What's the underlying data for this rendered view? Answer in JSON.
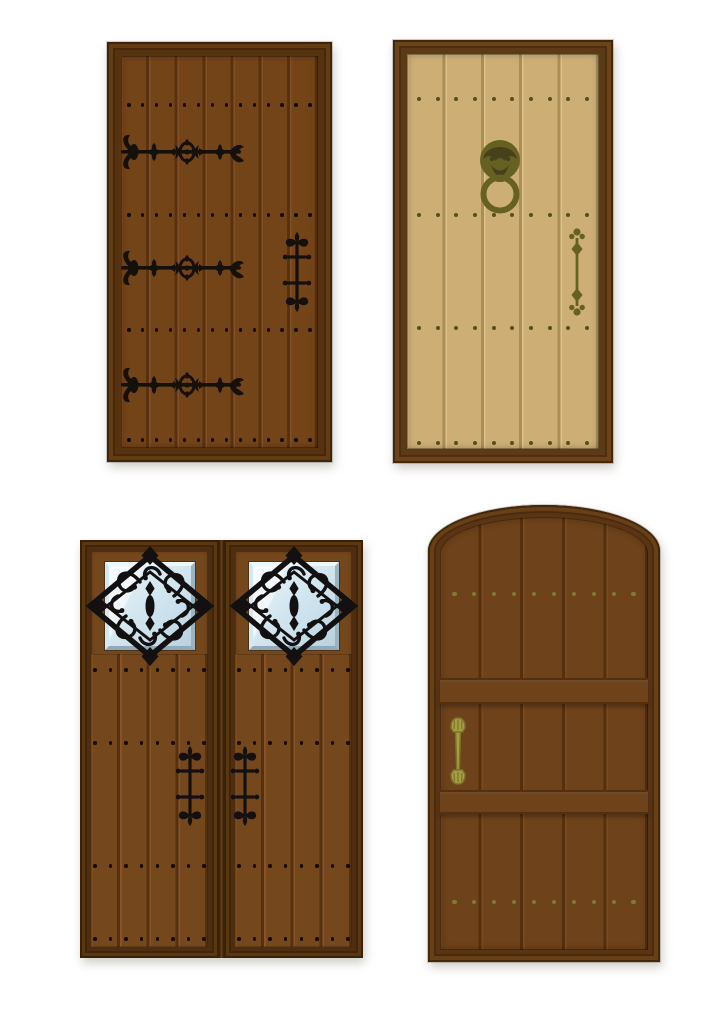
{
  "scene": {
    "description": "Vector illustration of four rustic medieval wooden doors with wrought-iron and brass hardware",
    "background": "#ffffff"
  },
  "doors": [
    {
      "name": "top-left-door",
      "style": "dark brown plank door with three ornate wrought-iron strap hinges and a cross-shaped handle",
      "palette": {
        "frame": "#56320f",
        "frameEdge": "#402409",
        "frameHi": "#633c14",
        "plank": "#744419",
        "groove": "#583210",
        "highlight": "#835026",
        "hardware": "#15100a",
        "hardwareDark": "#000000"
      },
      "planks": 7,
      "nails": {
        "per_row": 14,
        "rows": 4,
        "color": "#140c05",
        "size": 3.5
      },
      "hardware": [
        {
          "icon": "ornate-hinge-icon",
          "count": 3
        },
        {
          "icon": "cross-handle-icon",
          "count": 1
        }
      ]
    },
    {
      "name": "top-right-door",
      "style": "tan plank door with olive-brass ring knocker and vertical bar handle",
      "palette": {
        "frame": "#5d3a16",
        "frameEdge": "#44280c",
        "frameHi": "#6b4419",
        "plank": "#cdaf76",
        "groove": "#aa8e54",
        "highlight": "#dcc28d",
        "hardware": "#666023",
        "hardwareDark": "#46411a"
      },
      "planks": 5,
      "nails": {
        "per_row": 10,
        "rows": 4,
        "color": "#584e21",
        "size": 4
      },
      "hardware": [
        {
          "icon": "ring-knocker-icon",
          "count": 1
        },
        {
          "icon": "bar-handle-icon",
          "count": 1
        }
      ]
    },
    {
      "name": "bottom-left-double-door",
      "style": "double brown plank door, each leaf with a beveled glass window behind a diamond iron grille and a cross-shaped handle",
      "palette": {
        "frame": "#4e2e0e",
        "frameEdge": "#392107",
        "frameHi": "#5a370f",
        "plank": "#75471c",
        "groove": "#563110",
        "highlight": "#855327",
        "hardware": "#131011",
        "hardwareDark": "#000000",
        "glassLight": "#e9f4fa",
        "glass": "#c9dfeb",
        "bevelLight": "#eff7fb",
        "bevelDark": "#9bb4c2",
        "gapDark": "#2f1c09",
        "gapMid": "#6a3f18"
      },
      "leaves": 2,
      "planks_per_leaf": 4,
      "nails": {
        "per_row": 8,
        "rows": 4,
        "color": "#140c05",
        "size": 3.5
      },
      "hardware": [
        {
          "icon": "window-grille-icon",
          "count": 2
        },
        {
          "icon": "cross-handle-icon",
          "count": 2
        }
      ]
    },
    {
      "name": "bottom-right-arched-door",
      "style": "arched brown plank door with two horizontal rails and an olive-brass pull handle",
      "palette": {
        "frame": "#5b3513",
        "frameEdge": "#432708",
        "frameHi": "#684017",
        "plank": "#6e421a",
        "groove": "#55300e",
        "highlight": "#7b4b1f",
        "hardware": "#a89e41",
        "hardwareDark": "#7a742c"
      },
      "planks": 5,
      "nails": {
        "per_row": 10,
        "rows": 2,
        "color": "#7c7c33",
        "size": 4.5
      },
      "hardware": [
        {
          "icon": "pull-handle-icon",
          "count": 1
        }
      ]
    }
  ]
}
